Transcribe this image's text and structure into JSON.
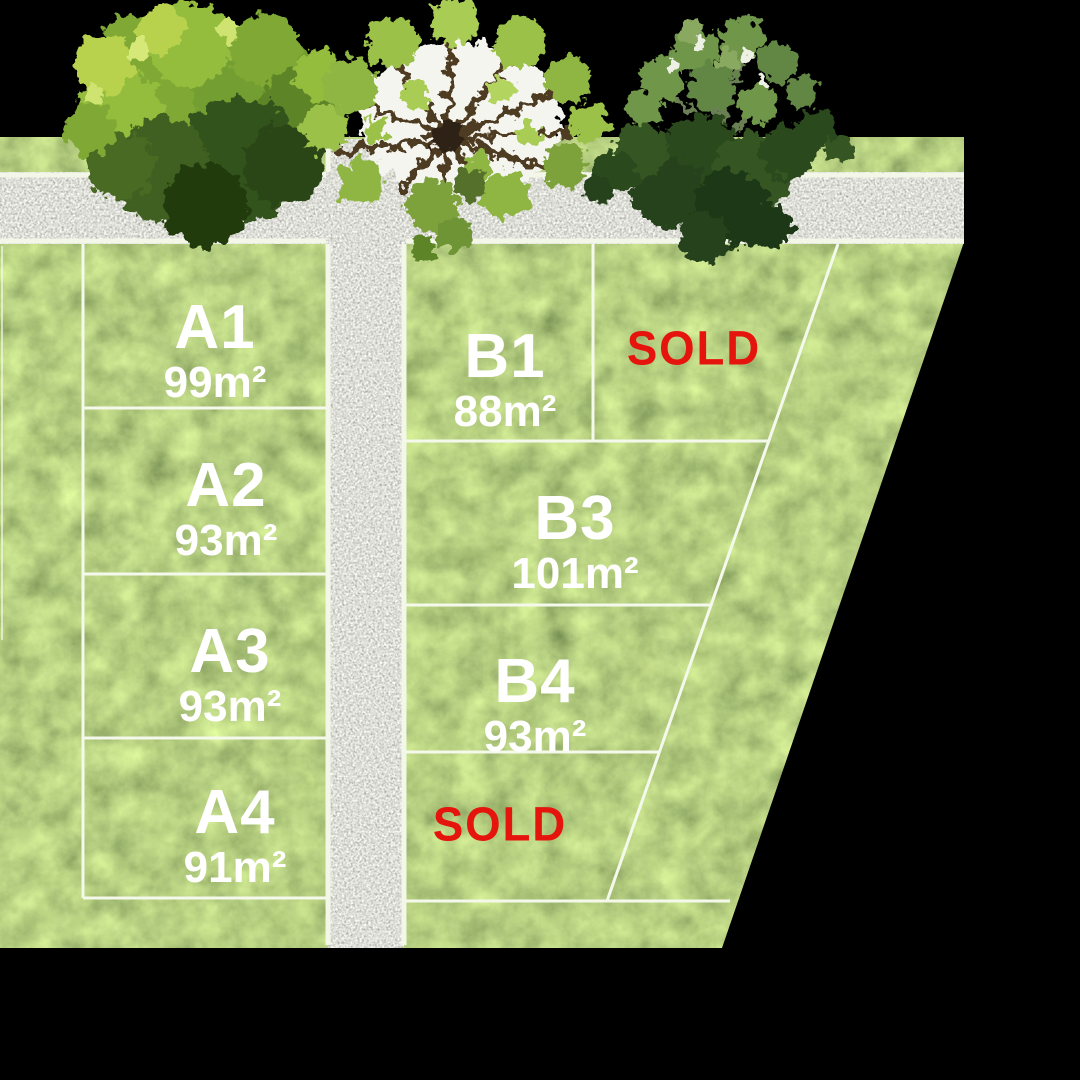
{
  "plan": {
    "type": "land-subdivision-site-plan",
    "sold_label": "SOLD"
  },
  "lots": {
    "a": [
      {
        "code": "A1",
        "area": "99m²"
      },
      {
        "code": "A2",
        "area": "93m²"
      },
      {
        "code": "A3",
        "area": "93m²"
      },
      {
        "code": "A4",
        "area": "91m²"
      }
    ],
    "b": [
      {
        "code": "B1",
        "area": "88m²"
      },
      {
        "code": "B3",
        "area": "101m²"
      },
      {
        "code": "B4",
        "area": "93m²"
      }
    ]
  },
  "colors": {
    "background": "#000000",
    "grass_mid": "#79a138",
    "grass_dark": "#33531a",
    "grass_light": "#c9dd78",
    "road_gravel": "#bdbdb8",
    "boundary_line": "#f5f9ec",
    "lot_text": "#ffffff",
    "sold_text": "#e5150e"
  }
}
